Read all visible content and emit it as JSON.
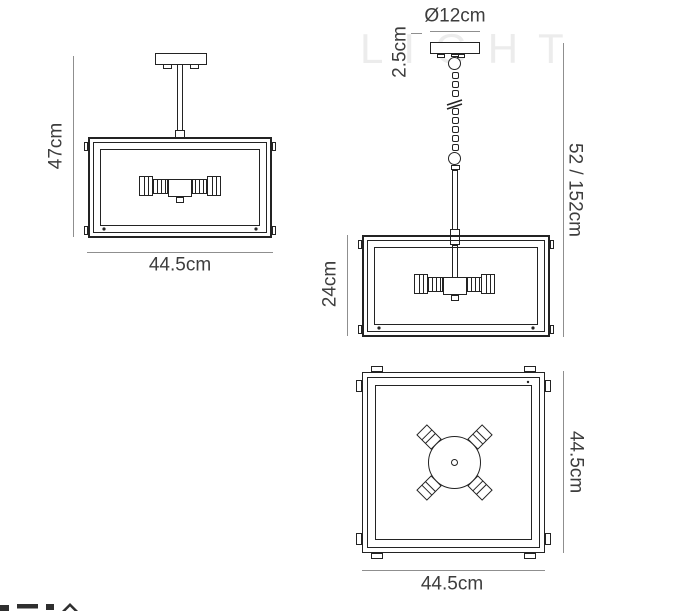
{
  "watermark": {
    "text": "LIGHT"
  },
  "colors": {
    "line": "#232323",
    "dim_line": "#8f8f8f",
    "label_text": "#3d3d3d",
    "watermark": "#ececec"
  },
  "views": {
    "semi_flush_front": {
      "height_label": "47cm",
      "width_label": "44.5cm"
    },
    "pendant_front": {
      "canopy_diameter_label": "Ø12cm",
      "canopy_thickness_label": "2.5cm",
      "shade_height_label": "24cm",
      "overall_drop_label": "52 / 152cm"
    },
    "top_view": {
      "depth_label": "44.5cm",
      "width_label": "44.5cm"
    }
  }
}
